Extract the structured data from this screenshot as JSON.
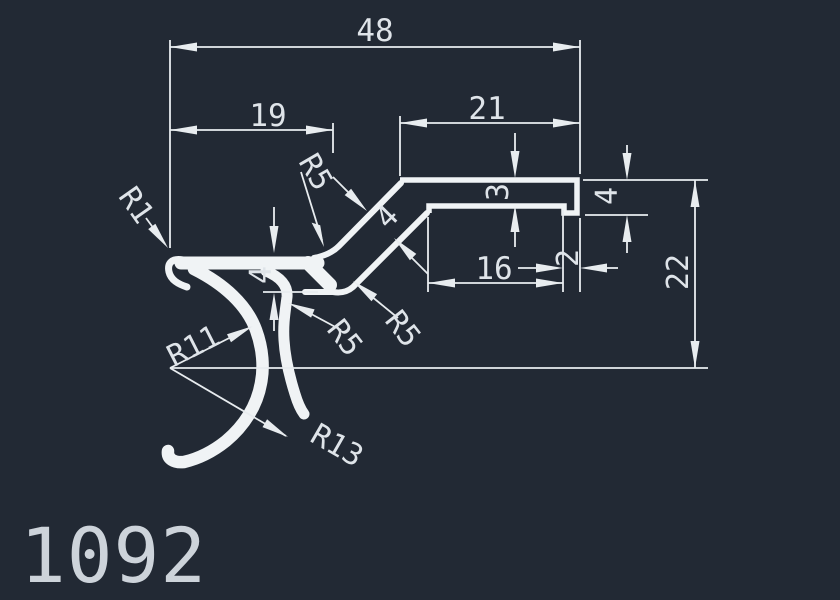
{
  "drawing": {
    "part_number": "1092",
    "colors": {
      "background": "#222934",
      "profile_lines": "#f0f3f5",
      "dimension_lines": "#e8ecef",
      "dimension_text": "#dfe4e9",
      "title_text": "#cdd3da"
    },
    "dims": {
      "overall_width": "48",
      "arm_width": "19",
      "flange_width": "21",
      "groove_width": "16",
      "lip_width": "2",
      "flange_thickness": "3",
      "lip_thickness": "4",
      "arm_stack_thickness": "4",
      "diag_thickness": "4",
      "overall_height": "22"
    },
    "radii": {
      "tip_radius": "R1",
      "top_fillet": "R5",
      "under_fillet": "R5",
      "diag_fillet": "R5",
      "hook_inner": "R11",
      "hook_outer": "R13"
    }
  }
}
